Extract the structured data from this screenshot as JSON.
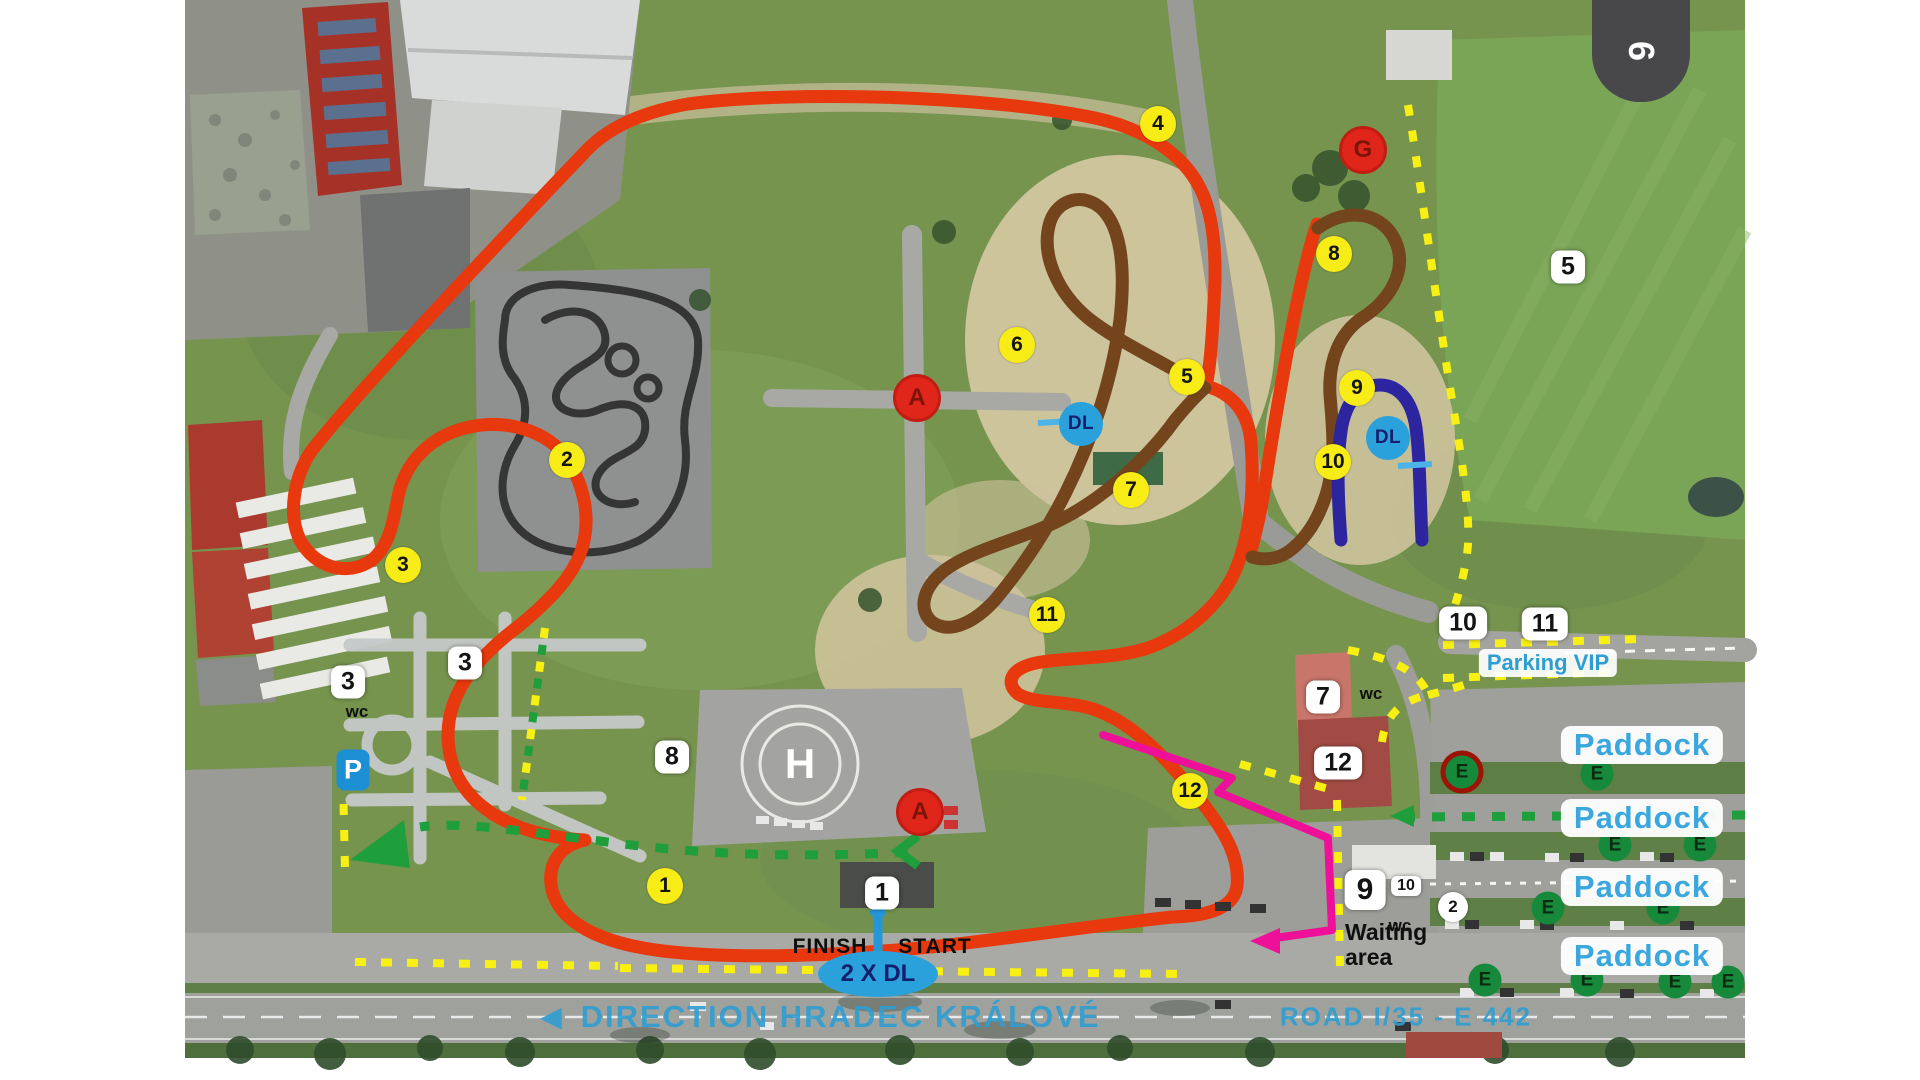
{
  "page": {
    "badge": "6"
  },
  "colors": {
    "track_main": "#e8380d",
    "track_offroad": "#74451c",
    "track_handling": "#2d25a0",
    "pit_route_green": "#1f9e3c",
    "boundary_yellow": "#f8ef13",
    "exit_route_magenta": "#ee1099",
    "dl_blue": "#2ba1dc",
    "marker_yellow": "#f7ec15",
    "marker_red": "#e0251a",
    "paddock_text_blue": "#3aa7de"
  },
  "corners": [
    "1",
    "2",
    "3",
    "4",
    "5",
    "6",
    "7",
    "8",
    "9",
    "10",
    "11",
    "12"
  ],
  "zones": {
    "z3_left": "3",
    "z3_school": "3",
    "z8": "8",
    "z5": "5",
    "z7": "7",
    "z12": "12",
    "z1": "1",
    "z10_vip": "10",
    "z11_vip": "11",
    "z9": "9",
    "z10_small": "10",
    "z2_circle": "2"
  },
  "posts": {
    "a_upper": "A",
    "a_lower": "A",
    "g": "G"
  },
  "dl": {
    "upper": "DL",
    "right": "DL",
    "start_note": "2 X DL"
  },
  "paddock": {
    "e": "E",
    "label1": "Paddock",
    "label2": "Paddock",
    "label3": "Paddock",
    "label4": "Paddock",
    "parking_vip": "Parking VIP"
  },
  "texts": {
    "finish": "FINISH",
    "start": "START",
    "waiting_line1": "Waiting",
    "waiting_line2": "area",
    "wc_school": "wc",
    "wc_7": "wc",
    "wc_9": "wc",
    "p_sign": "P",
    "helipad": "H",
    "direction_arrow": "◄",
    "direction": "DIRECTION HRADEC KRÁLOVÉ",
    "road": "ROAD I/35 - E 442"
  }
}
